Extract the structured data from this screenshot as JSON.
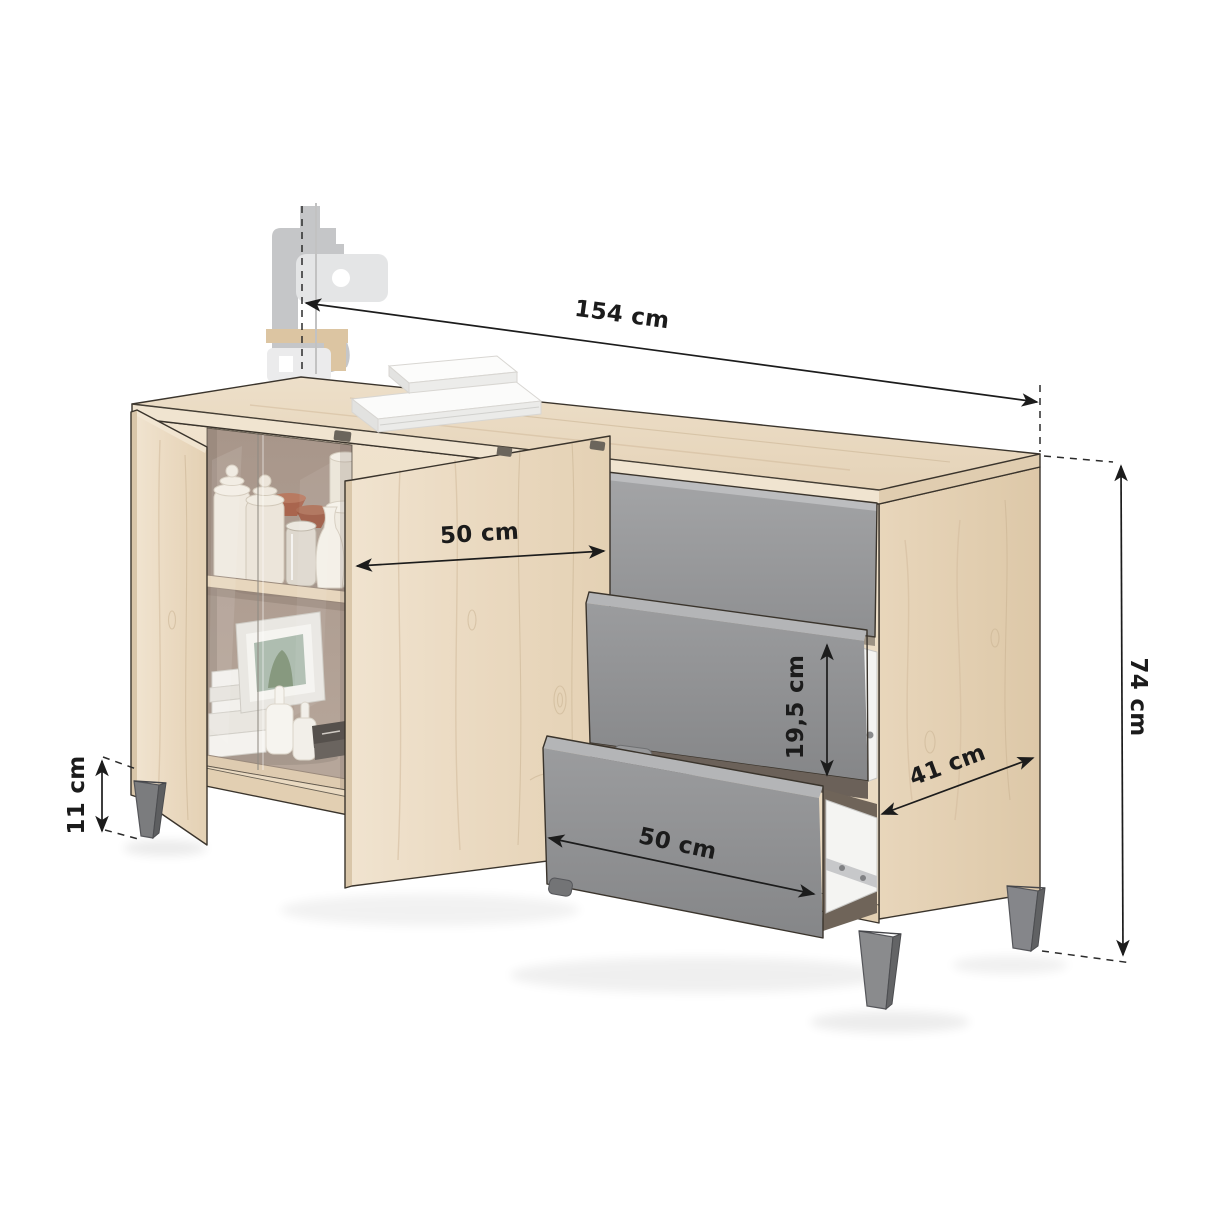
{
  "scene": {
    "type": "furniture-dimension-diagram",
    "product_type": "sideboard with doors and drawers",
    "background": "#ffffff"
  },
  "dimensions": {
    "width": {
      "label": "154 cm"
    },
    "height": {
      "label": "74 cm"
    },
    "depth": {
      "label": "41 cm"
    },
    "door_width": {
      "label": "50 cm"
    },
    "drawer_front_height": {
      "label": "19,5 cm"
    },
    "drawer_width": {
      "label": "50 cm"
    },
    "leg_height": {
      "label": "11 cm"
    }
  },
  "colors": {
    "wood_top": "#e9d9c1",
    "wood_front": "#efe2cd",
    "wood_side": "#e3d0b3",
    "drawer_grey": "#97989a",
    "leg_grey": "#7b7c7e",
    "interior_back": "#b1a094",
    "outline": "#3a342c",
    "dimension_line": "#1c1c1c"
  }
}
